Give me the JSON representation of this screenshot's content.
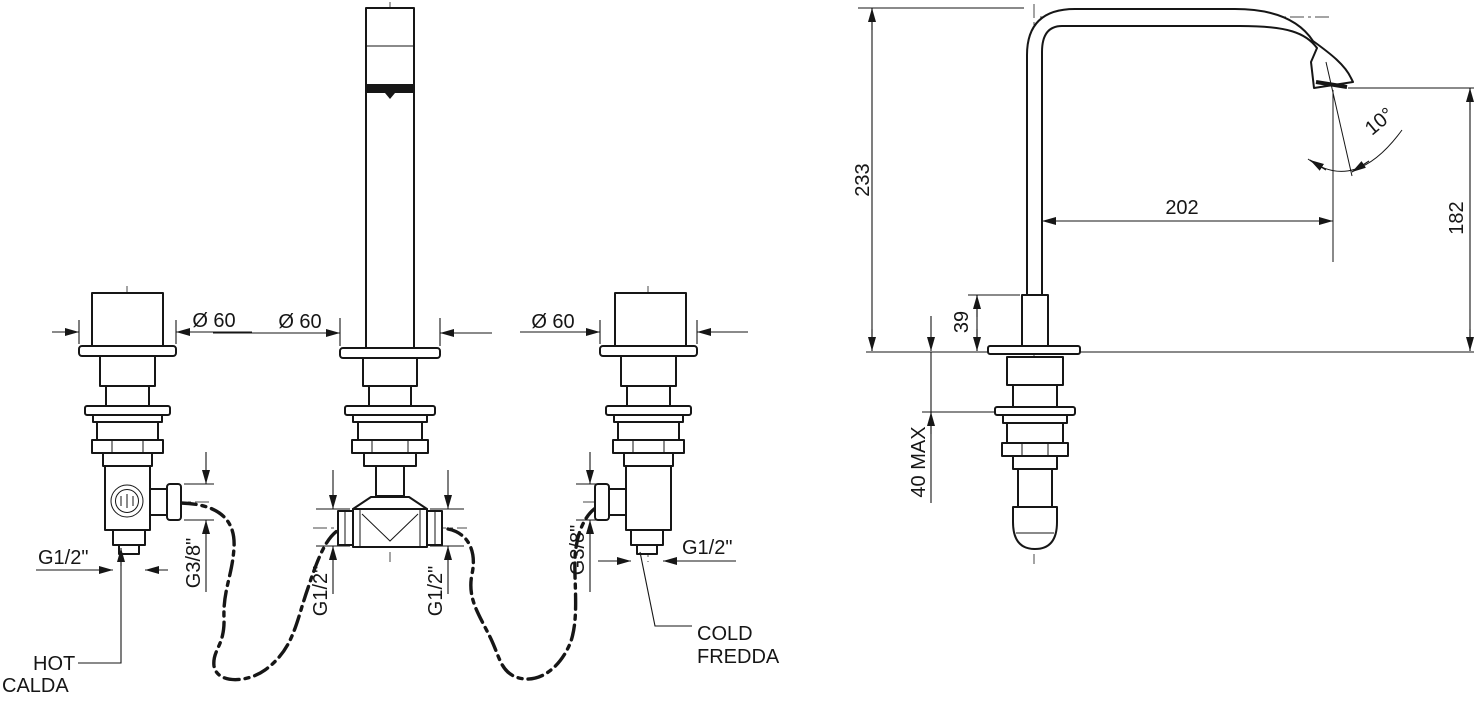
{
  "drawing": {
    "title": "3-hole deck-mounted basin mixer - technical installation drawing",
    "views": {
      "front": "front view (spout + hot/cold valves)",
      "side": "side view (spout profile)"
    }
  },
  "labels": {
    "dia_hot": "Ø 60",
    "dia_spout": "Ø 60",
    "dia_cold": "Ø 60",
    "g12_hot": "G1/2\"",
    "g38_hot": "G3/8\"",
    "g12_tee_left": "G1/2\"",
    "g12_tee_right": "G1/2\"",
    "g38_cold": "G3/8\"",
    "g12_cold": "G1/2\"",
    "hot_en": "HOT",
    "hot_it": "CALDA",
    "cold_en": "COLD",
    "cold_it": "FREDDA"
  },
  "dimensions": {
    "overall_height": "233",
    "spout_reach": "202",
    "outlet_height": "182",
    "base_height": "39",
    "deck_thickness_max": "40 MAX",
    "outlet_angle": "10°"
  },
  "colors": {
    "line": "#161616",
    "background": "#ffffff"
  }
}
